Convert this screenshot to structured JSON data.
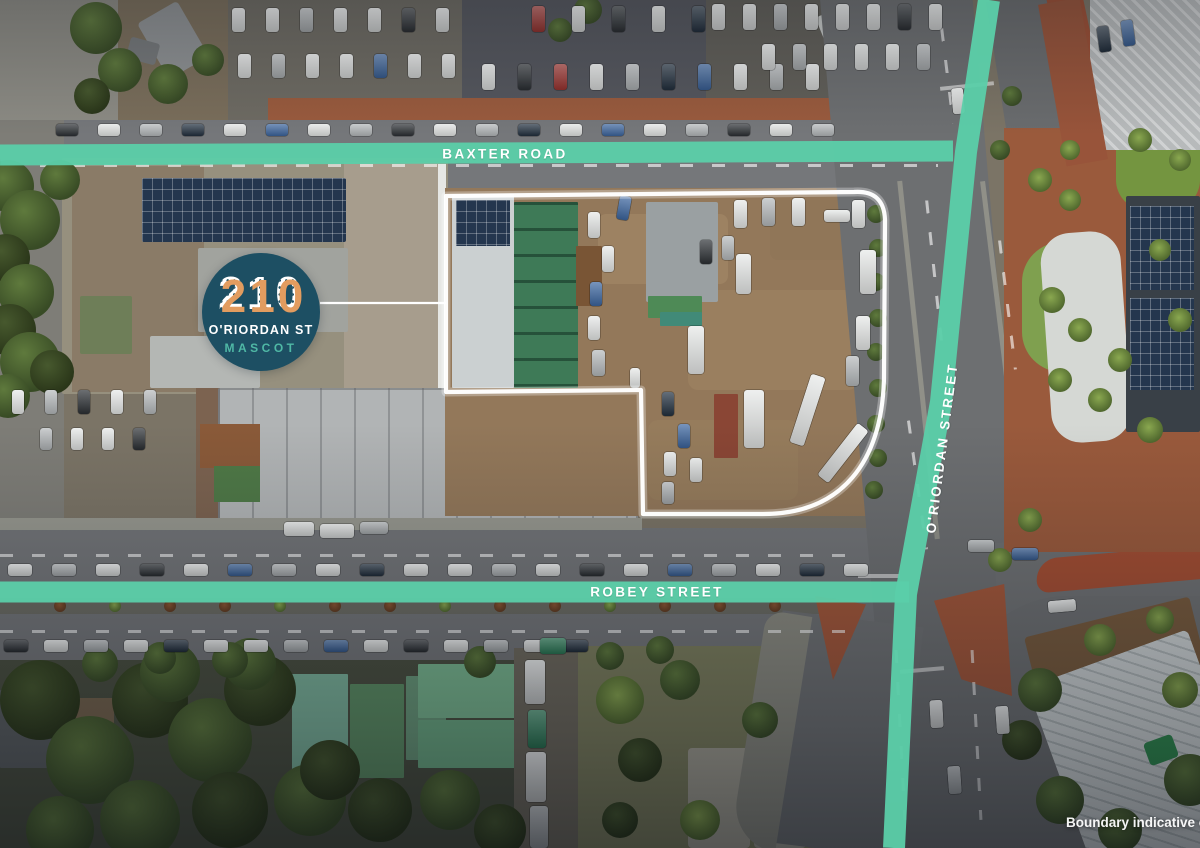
{
  "overlay": {
    "street_labels": [
      {
        "id": "baxter-road",
        "text": "BAXTER ROAD"
      },
      {
        "id": "robey-street",
        "text": "ROBEY STREET"
      },
      {
        "id": "oriordan-street",
        "text": "O'RIORDAN STREET"
      }
    ],
    "badge": {
      "number": "210",
      "street": "O'RIORDAN ST",
      "suburb": "MASCOT"
    },
    "disclaimer": "Boundary indicative only",
    "road_paint_texts": [
      "QANTAS DRIVE",
      "QANTAS DRIVE"
    ],
    "colors": {
      "street_bar": "#5bcfa9",
      "badge_background": "#1d4f63",
      "badge_suburb_text": "#4fb8a5",
      "badge_number_shadow": "#e29c5f",
      "boundary_line": "#ffffff"
    }
  }
}
